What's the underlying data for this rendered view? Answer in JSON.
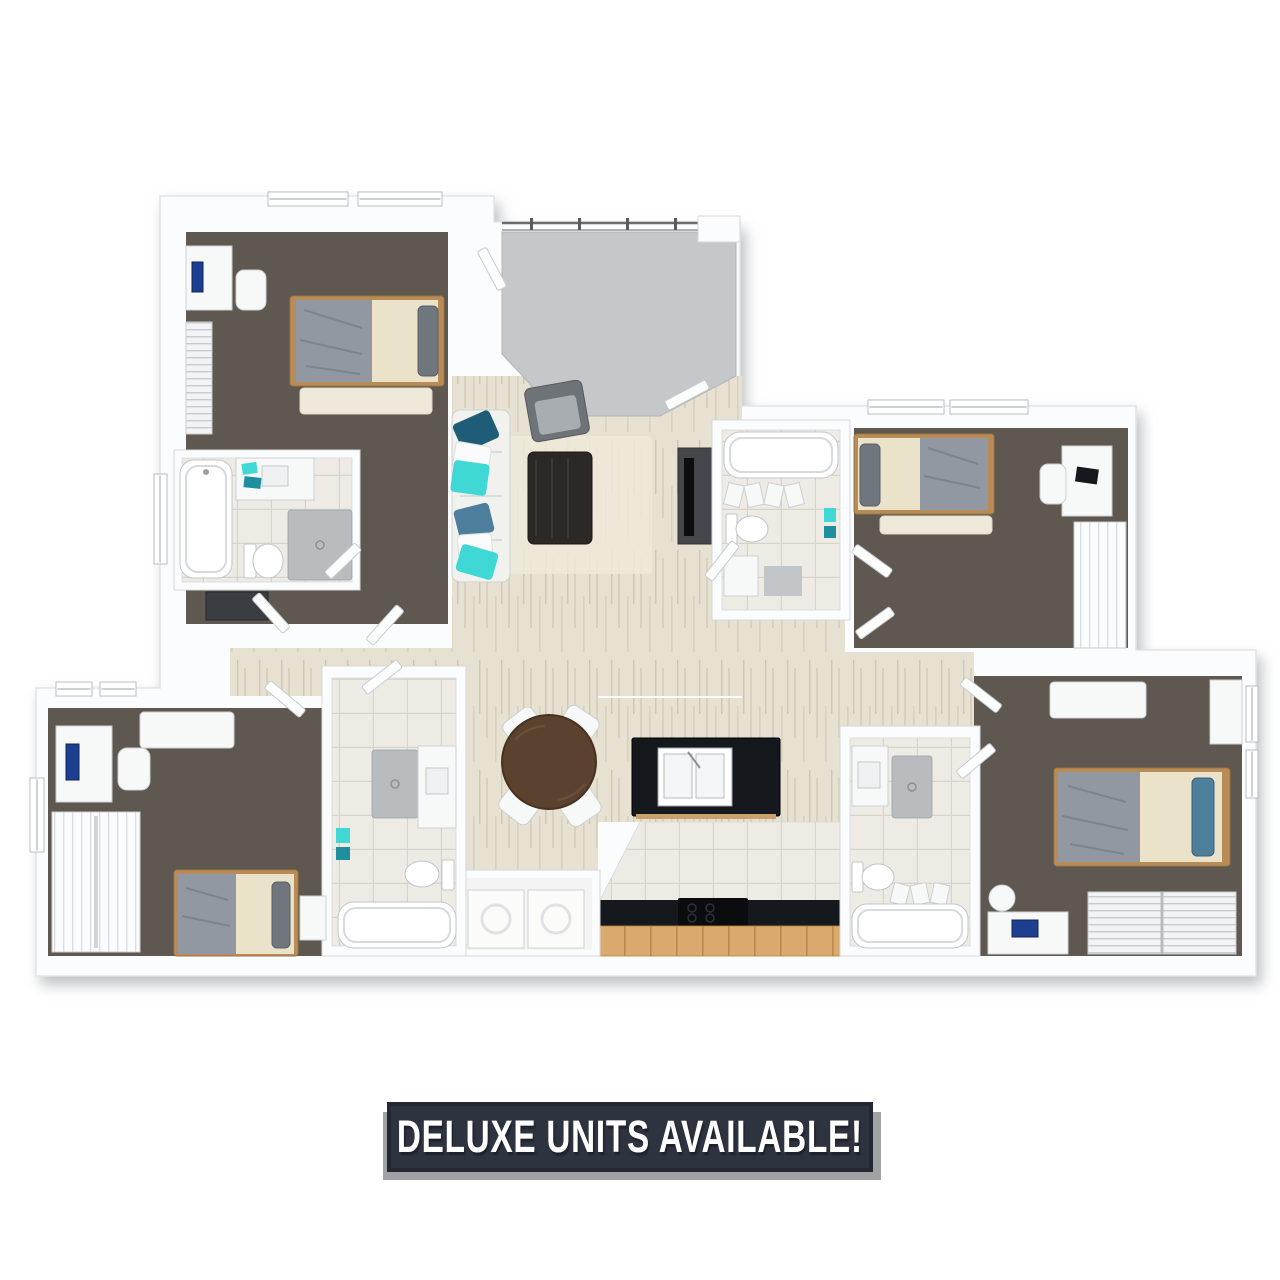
{
  "banner": {
    "label": "DELUXE UNITS AVAILABLE!"
  },
  "colors": {
    "wall": "#fbfcfd",
    "wall_edge": "#d5d8da",
    "shadow": "#bcbfc2",
    "bedroom_floor": "#5f5850",
    "wood_floor": "#e7e1d2",
    "tile_floor": "#edebe4",
    "entry_floor": "#c5c8ca",
    "counter_black": "#15181d",
    "cabinet_wood": "#d9a96e",
    "table_wood": "#5a422e",
    "accent_teal": "#40d8d5",
    "pillow_navy": "#1f5c77",
    "pillow_steel": "#4d7e9c",
    "blanket_gray": "#9298a2",
    "mattress_cream": "#eae2c9",
    "appliance_gray": "#b9bcbe",
    "banner_bg": "#2e3340",
    "banner_border": "#232833",
    "banner_text": "#ffffff",
    "banner_shadow": "#a0a2a4"
  },
  "floorplan": {
    "type": "3d-floor-plan",
    "bedrooms": 4,
    "bathrooms": 4,
    "rooms": [
      "balcony-entry",
      "bedroom-top-left",
      "bathroom-top-left",
      "living-room",
      "dining-area",
      "kitchen",
      "laundry-closet",
      "bathroom-center-top",
      "bedroom-top-right",
      "bathroom-bottom-left",
      "bedroom-bottom-left",
      "bathroom-bottom-right",
      "bedroom-bottom-right"
    ]
  }
}
